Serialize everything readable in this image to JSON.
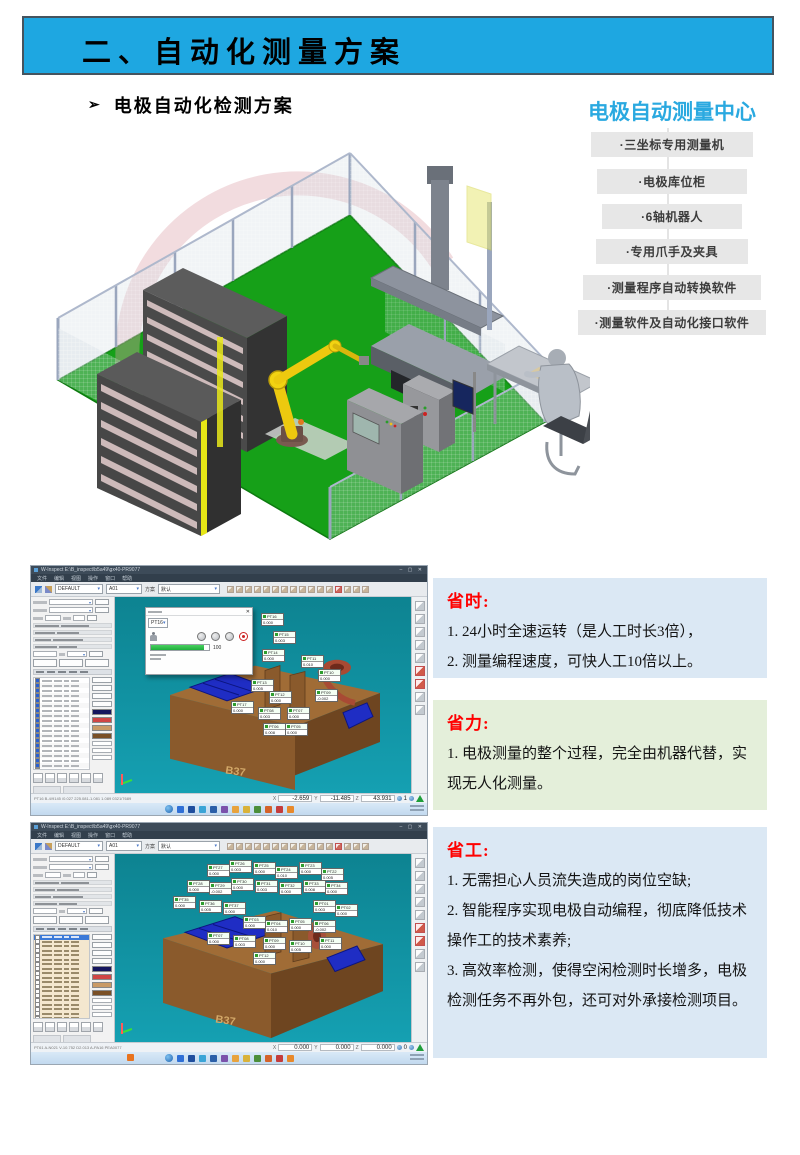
{
  "slide": {
    "header_title": "二、自动化测量方案",
    "bullet_glyph": "➢",
    "subtitle": "电极自动化检测方案",
    "center": {
      "title": "电极自动测量中心",
      "items": [
        "·三坐标专用测量机",
        "·电极库位柜",
        "·6轴机器人",
        "·专用爪手及夹具",
        "·测量程序自动转换软件",
        "·测量软件及自动化接口软件"
      ]
    },
    "benefits": [
      {
        "title": "省时:",
        "lines": [
          "1. 24小时全速运转（是人工时长3倍），",
          "2. 测量编程速度，可快人工10倍以上。"
        ]
      },
      {
        "title": "省力:",
        "lines": [
          "1. 电极测量的整个过程，完全由机器代替，实现无人化测量。"
        ]
      },
      {
        "title": "省工:",
        "lines": [
          "1. 无需担心人员流失造成的岗位空缺;",
          "2. 智能程序实现电极自动编程，彻底降低技术操作工的技术素养;",
          "3. 高效率检测，使得空闲检测时长增多，电极检测任务不再外包，还可对外承接检测项目。"
        ]
      }
    ]
  },
  "cmm": {
    "menu_items": [
      "文件",
      "编辑",
      "视图",
      "操作",
      "窗口",
      "帮助"
    ],
    "toolbar": {
      "combo1": "DEFAULT",
      "combo2": "A01",
      "label": "方案",
      "combo3": "默认"
    },
    "coord_labels": [
      "X",
      "Y",
      "Z"
    ],
    "swatches": [
      "#15155e",
      "#d04545",
      "#c99a66",
      "#7a5026"
    ],
    "taskbar_colors": [
      "#2f6fd6",
      "#1f4e9e",
      "#3aa4d6",
      "#2b5fa8",
      "#7b52ab",
      "#e8a33d",
      "#d9b23a",
      "#4c8f3a",
      "#d4622a",
      "#c43c3c",
      "#e8892b"
    ],
    "windows": [
      {
        "title": "W-Inspect  E:\\B_inspect\\b5a49\\gx40-PR9077",
        "window_buttons": "–  ▢  ✕",
        "part_label": "B37",
        "status_info": "PT16  B-4/9145 /0.027 225.081-1.081 1.089 0321/7689",
        "coord_x": "-2.659",
        "coord_y": "-11.485",
        "coord_z": "43.931",
        "coord_n": "1",
        "dialog": {
          "combo": "PT16",
          "progress": "100"
        },
        "rows": 20,
        "tags": [
          {
            "l": "PT16",
            "v": "0.000",
            "x": 146,
            "y": 16
          },
          {
            "l": "PT15",
            "v": "0.003",
            "x": 158,
            "y": 34
          },
          {
            "l": "PT14",
            "v": "0.000",
            "x": 147,
            "y": 52
          },
          {
            "l": "PT11",
            "v": "0.010",
            "x": 186,
            "y": 58
          },
          {
            "l": "PT10",
            "v": "0.000",
            "x": 203,
            "y": 72
          },
          {
            "l": "PT13",
            "v": "0.005",
            "x": 136,
            "y": 82
          },
          {
            "l": "PT12",
            "v": "0.000",
            "x": 154,
            "y": 94
          },
          {
            "l": "PT09",
            "v": "-0.002",
            "x": 200,
            "y": 92
          },
          {
            "l": "PT17",
            "v": "0.000",
            "x": 116,
            "y": 104
          },
          {
            "l": "PT08",
            "v": "0.003",
            "x": 143,
            "y": 110
          },
          {
            "l": "PT07",
            "v": "0.000",
            "x": 172,
            "y": 110
          },
          {
            "l": "PT06",
            "v": "0.008",
            "x": 148,
            "y": 126
          },
          {
            "l": "PT05",
            "v": "0.000",
            "x": 170,
            "y": 126
          }
        ]
      },
      {
        "title": "W-Inspect  E:\\B_inspect\\b5a49\\gx40-PR9077",
        "window_buttons": "–  ▢  ✕",
        "part_label": "B37",
        "status_info": "PT61  A-N021 V-10.752 D2.013 A-PA16 PEA0077",
        "coord_x": "0.000",
        "coord_y": "0.000",
        "coord_z": "0.000",
        "coord_n": "0",
        "rows": 24,
        "tags": [
          {
            "l": "PT27",
            "v": "0.000",
            "x": 92,
            "y": 10
          },
          {
            "l": "PT26",
            "v": "0.003",
            "x": 114,
            "y": 6
          },
          {
            "l": "PT25",
            "v": "0.000",
            "x": 138,
            "y": 8
          },
          {
            "l": "PT24",
            "v": "0.010",
            "x": 160,
            "y": 12
          },
          {
            "l": "PT23",
            "v": "0.000",
            "x": 184,
            "y": 8
          },
          {
            "l": "PT22",
            "v": "0.005",
            "x": 206,
            "y": 14
          },
          {
            "l": "PT28",
            "v": "0.000",
            "x": 72,
            "y": 26
          },
          {
            "l": "PT29",
            "v": "-0.002",
            "x": 94,
            "y": 28
          },
          {
            "l": "PT30",
            "v": "0.000",
            "x": 116,
            "y": 24
          },
          {
            "l": "PT31",
            "v": "0.003",
            "x": 140,
            "y": 26
          },
          {
            "l": "PT32",
            "v": "0.000",
            "x": 164,
            "y": 28
          },
          {
            "l": "PT33",
            "v": "0.008",
            "x": 188,
            "y": 26
          },
          {
            "l": "PT34",
            "v": "0.000",
            "x": 210,
            "y": 28
          },
          {
            "l": "PT35",
            "v": "0.000",
            "x": 58,
            "y": 42
          },
          {
            "l": "PT36",
            "v": "0.005",
            "x": 84,
            "y": 46
          },
          {
            "l": "PT37",
            "v": "0.000",
            "x": 108,
            "y": 48
          },
          {
            "l": "PT01",
            "v": "0.003",
            "x": 198,
            "y": 46
          },
          {
            "l": "PT02",
            "v": "0.000",
            "x": 220,
            "y": 50
          },
          {
            "l": "PT03",
            "v": "0.000",
            "x": 128,
            "y": 62
          },
          {
            "l": "PT04",
            "v": "0.010",
            "x": 150,
            "y": 66
          },
          {
            "l": "PT05",
            "v": "0.000",
            "x": 174,
            "y": 64
          },
          {
            "l": "PT06",
            "v": "-0.002",
            "x": 198,
            "y": 66
          },
          {
            "l": "PT07",
            "v": "0.000",
            "x": 92,
            "y": 78
          },
          {
            "l": "PT08",
            "v": "0.003",
            "x": 118,
            "y": 81
          },
          {
            "l": "PT09",
            "v": "0.000",
            "x": 148,
            "y": 83
          },
          {
            "l": "PT10",
            "v": "0.005",
            "x": 174,
            "y": 86
          },
          {
            "l": "PT11",
            "v": "0.000",
            "x": 204,
            "y": 83
          },
          {
            "l": "PT12",
            "v": "0.000",
            "x": 138,
            "y": 98
          }
        ]
      }
    ]
  }
}
